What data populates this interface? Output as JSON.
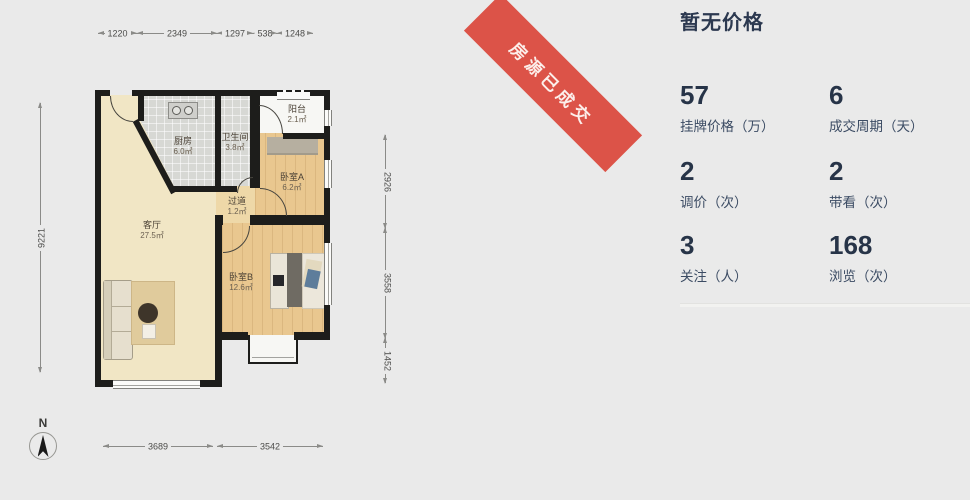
{
  "ribbon": {
    "label": "房源已成交",
    "color": "#dc5348"
  },
  "price_panel": {
    "title": "暂无价格",
    "stats": [
      {
        "value": "57",
        "label": "挂牌价格（万）"
      },
      {
        "value": "6",
        "label": "成交周期（天）"
      },
      {
        "value": "2",
        "label": "调价（次）"
      },
      {
        "value": "2",
        "label": "带看（次）"
      },
      {
        "value": "3",
        "label": "关注（人）"
      },
      {
        "value": "168",
        "label": "浏览（次）"
      }
    ]
  },
  "floorplan": {
    "compass": "N",
    "rooms": [
      {
        "name": "厨房",
        "area": "6.0㎡"
      },
      {
        "name": "卫生间",
        "area": "3.8㎡"
      },
      {
        "name": "阳台",
        "area": "2.1㎡"
      },
      {
        "name": "卧室A",
        "area": "6.2㎡"
      },
      {
        "name": "过道",
        "area": "1.2㎡"
      },
      {
        "name": "客厅",
        "area": "27.5㎡"
      },
      {
        "name": "卧室B",
        "area": "12.6㎡"
      }
    ],
    "dims": {
      "top": [
        "1220",
        "2349",
        "1297",
        "538",
        "1248"
      ],
      "left": [
        "9221"
      ],
      "right": [
        "2926",
        "3558",
        "1452"
      ],
      "bottom": [
        "3689",
        "3542"
      ]
    }
  },
  "colors": {
    "page_bg": "#eaeaea",
    "wall": "#1d1d1b",
    "accent_text": "#273448"
  }
}
